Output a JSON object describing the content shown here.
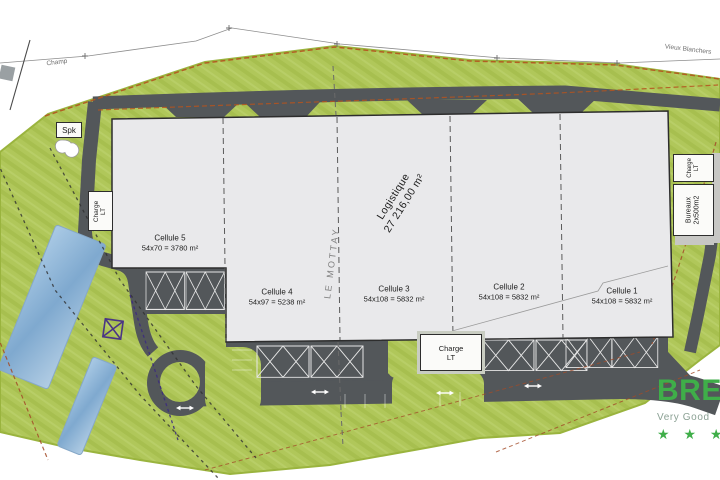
{
  "plan": {
    "place_labels": {
      "champ": "Champ",
      "vieux_blanchers": "Vieux Blanchers",
      "le_mottay": "LE MOTTAY"
    },
    "building": {
      "use_label": "Logistique",
      "total_area": "27 216,00 m²",
      "cells": [
        {
          "name": "Cellule 5",
          "dims": "54x70 = 3780 m²"
        },
        {
          "name": "Cellule 4",
          "dims": "54x97 = 5238 m²"
        },
        {
          "name": "Cellule 3",
          "dims": "54x108 = 5832 m²"
        },
        {
          "name": "Cellule 2",
          "dims": "54x108 = 5832 m²"
        },
        {
          "name": "Cellule 1",
          "dims": "54x108 = 5832 m²"
        }
      ],
      "bureaux": {
        "line1": "Bureaux",
        "line2": "2x500m2"
      }
    },
    "charge_label": {
      "line1": "Charge",
      "line2": "LT"
    },
    "spk_label": "Spk",
    "breeam": {
      "brand": "BREEAM",
      "rating": "Very Good",
      "stars": "★ ★ ★",
      "brand_color": "#3fae49"
    },
    "colors": {
      "grass": "#b0c75a",
      "asphalt": "#53575a",
      "building_fill": "#e9e9eb",
      "water_blue": "#7fa9cf",
      "boundary_orange": "#b5541f",
      "boundary_purple": "#3d2e7d"
    }
  }
}
